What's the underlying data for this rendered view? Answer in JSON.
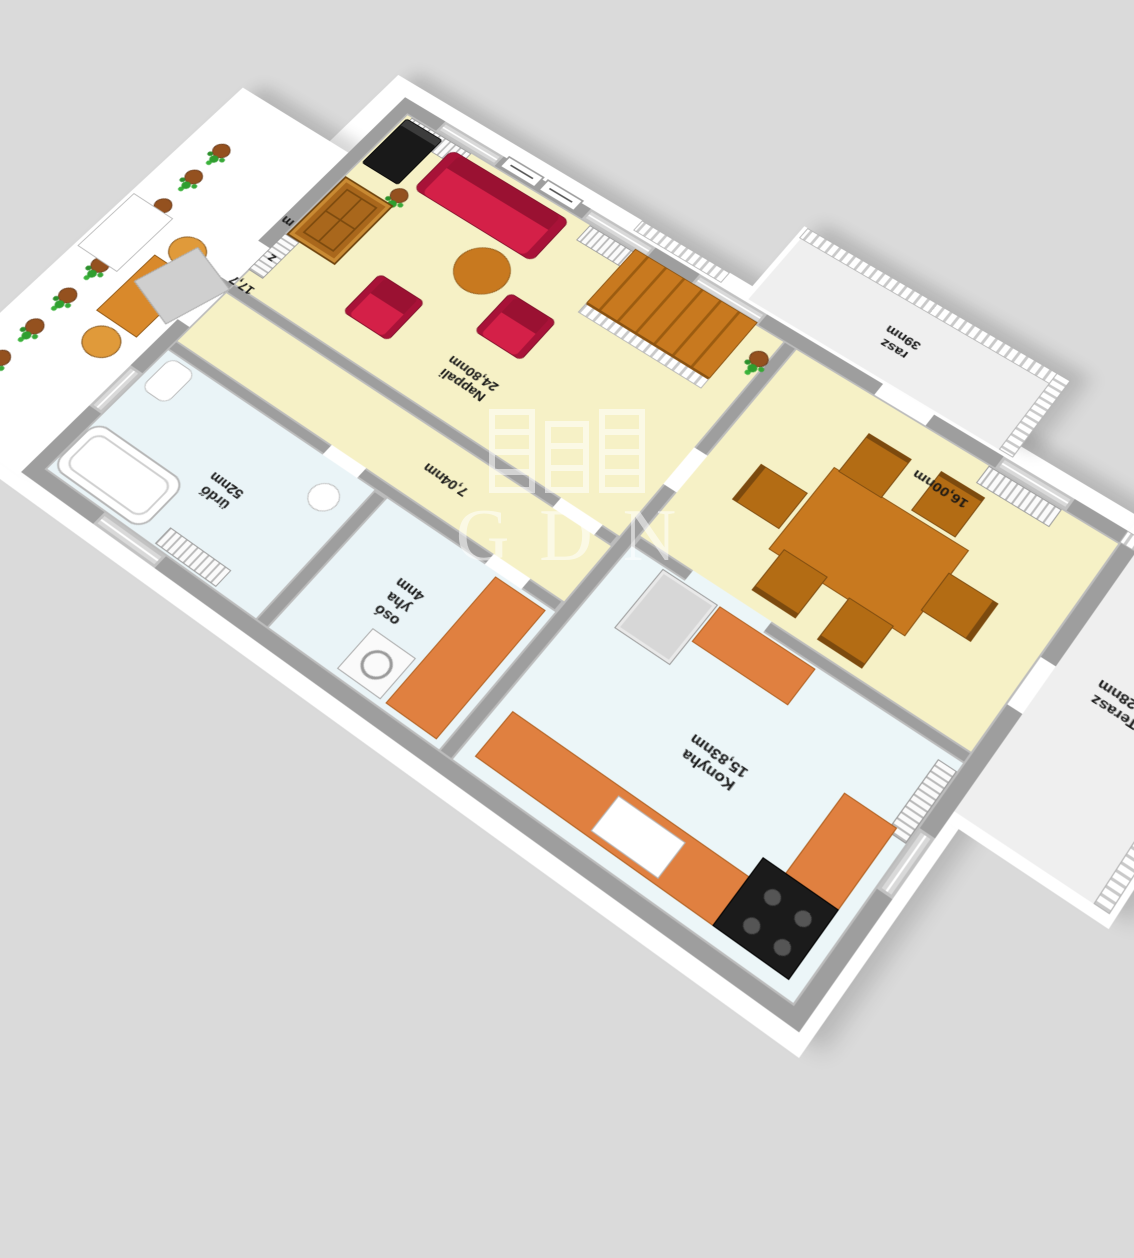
{
  "scene": {
    "background_color": "#dadada",
    "watermark": {
      "text": "GDN",
      "logo": "gdn-columns-emblem",
      "color": "#ffffff"
    }
  },
  "floorplan": {
    "labels": {
      "living": [
        "Nappali",
        "24,80nm"
      ],
      "dining": [
        "16,00nm"
      ],
      "kitchen": [
        "Konyha",
        "15,83nm"
      ],
      "hallway": [
        "7,04nm"
      ],
      "bathroom": [
        "ürdő",
        "52nm"
      ],
      "utility": [
        "osó",
        "yha",
        "4nm"
      ],
      "terrace_west": [
        "Terasz",
        "7,28nm"
      ],
      "terrace_south": [
        "rasz",
        "39nm"
      ],
      "balcony_door": [
        "17,7"
      ],
      "balcony_partial_1": "z",
      "balcony_partial_2": "m"
    },
    "palette": {
      "slab": "#ffffff",
      "walls": "#9e9e9e",
      "floor_living": "#f6f1c6",
      "floor_wet": "#eaf4f7",
      "kitchen_orange": "#e08040",
      "sofa_red": "#c81e46",
      "wood_brown": "#c8791f",
      "plant_green": "#2f9e2f"
    }
  }
}
